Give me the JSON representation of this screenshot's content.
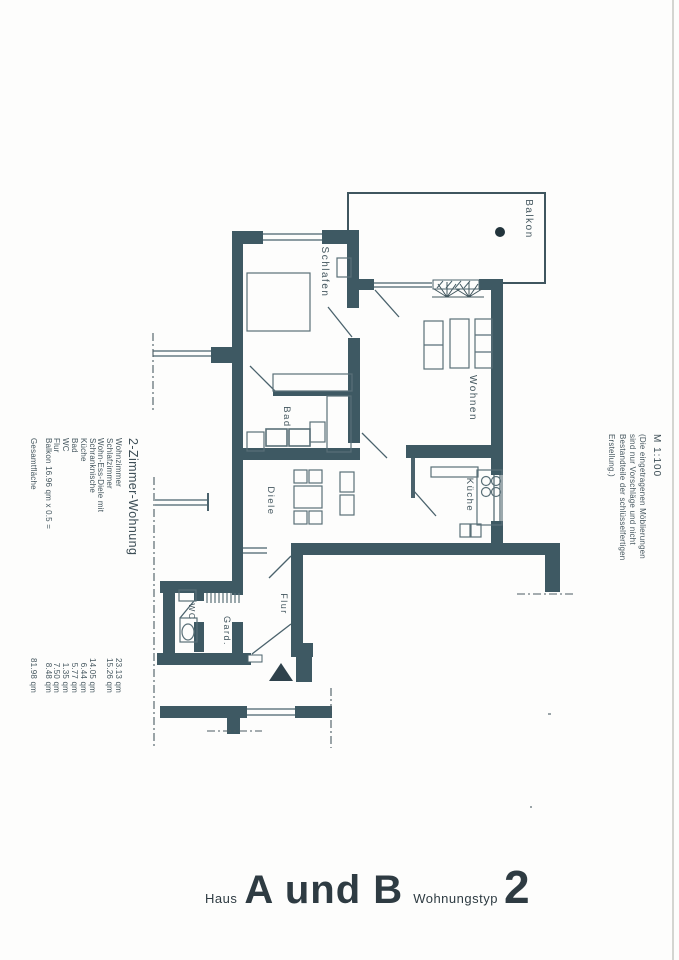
{
  "plan": {
    "scale_label": "M 1:100",
    "note_lines": [
      "(Die eingetragenen Möblierungen",
      "sind nur Vorschläge und nicht",
      "Bestandteile der schlüsselfertigen",
      "Erstellung.)"
    ],
    "rooms": {
      "balkon": "Balkon",
      "schlafen": "Schlafen",
      "wohnen": "Wohnen",
      "bad": "Bad",
      "diele": "Diele",
      "kueche": "Küche",
      "flur": "Flur",
      "garderobe": "Gard.",
      "wc": "WC"
    },
    "colors": {
      "wall": "#3e5963",
      "line": "#4a626c",
      "paper": "#fdfdfc",
      "ink": "#43565e"
    }
  },
  "area_table": {
    "title": "2-Zimmer-Wohnung",
    "unit": "qm",
    "rows": [
      {
        "label": "Wohnzimmer",
        "value": "23.13 qm"
      },
      {
        "label": "Schlafzimmer",
        "value": "15.26 qm"
      },
      {
        "label": "Wohn-Ess-Diele mit",
        "value": ""
      },
      {
        "label": "Schranknische",
        "value": "14.05 qm"
      },
      {
        "label": "Küche",
        "value": "6.44 qm"
      },
      {
        "label": "Bad",
        "value": "5.77 qm"
      },
      {
        "label": "WC",
        "value": "1.35 qm"
      },
      {
        "label": "Flur",
        "value": "7.50 qm"
      },
      {
        "label": "Balkon 16.96 qm x 0.5 =",
        "value": "8.48 qm"
      },
      {
        "label": "Gesamtfläche",
        "value": "81.98 qm"
      }
    ]
  },
  "footer": {
    "haus_label": "Haus",
    "haus_value": "A und B",
    "typ_label": "Wohnungstyp",
    "typ_value": "2"
  }
}
